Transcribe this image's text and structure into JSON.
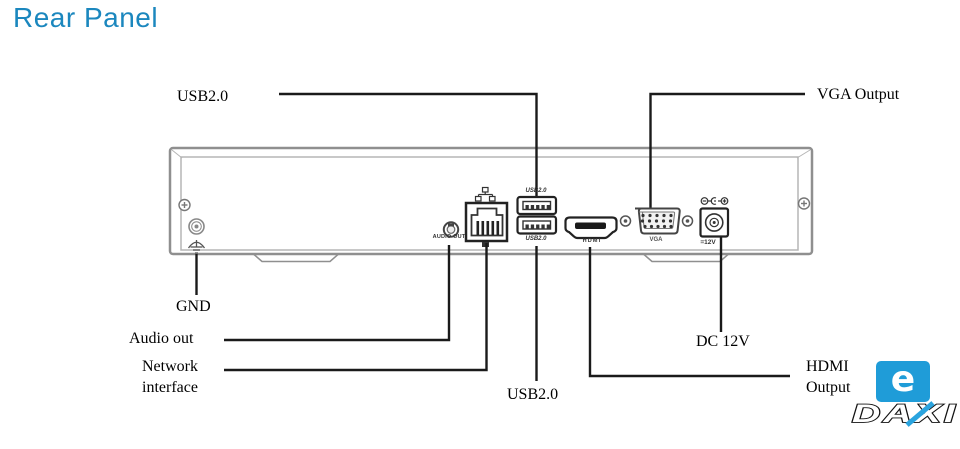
{
  "title": "Rear Panel",
  "callouts": {
    "usb_top": "USB2.0",
    "vga_output": "VGA Output",
    "gnd": "GND",
    "audio_out": "Audio out",
    "network": [
      "Network",
      "interface"
    ],
    "usb_bottom": "USB2.0",
    "dc_12v": "DC 12V",
    "hdmi_output": [
      "HDMI",
      "Output"
    ]
  },
  "panel_print": {
    "audio_out": "AUDIO OUT",
    "usb_top": "USB2.0",
    "usb_bottom": "USB2.0",
    "hdmi": "HDMI",
    "vga": "VGA",
    "dc": "=12V"
  },
  "logo": {
    "monogram": "e",
    "brand": "DAXI"
  },
  "colors": {
    "title_blue": "#1B87BE",
    "logo_blue": "#1F9CD8",
    "logo_x_blue": "#2AA4DF",
    "leader_black": "#1A1A1A",
    "chassis_gray": "#8F8F8F"
  }
}
